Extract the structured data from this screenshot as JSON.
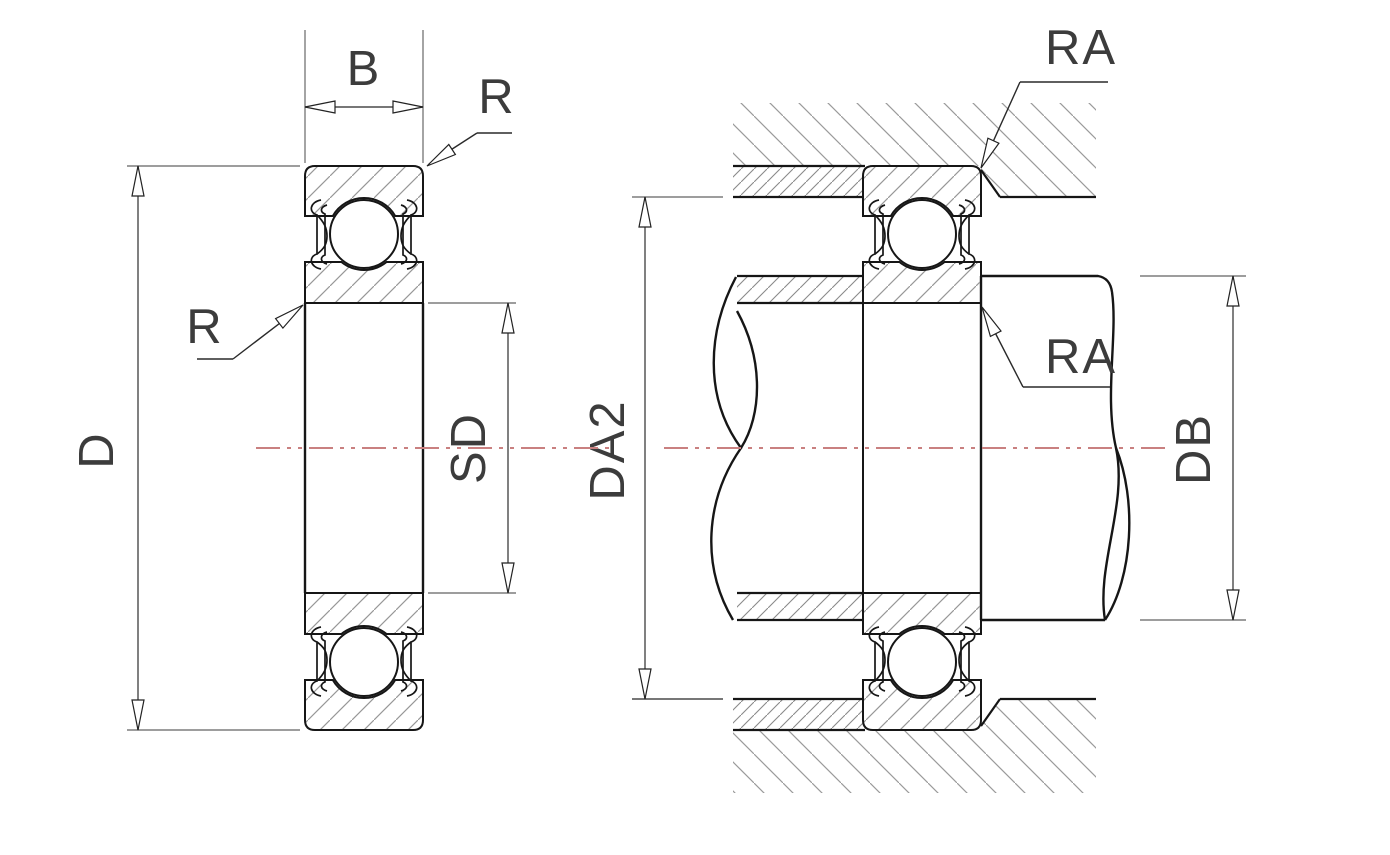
{
  "diagram": {
    "description": "Deep groove ball bearing cross-section drawing with mounting view",
    "left_view": {
      "labels": {
        "width": "B",
        "outer_radius": "R",
        "bore_radius": "R",
        "outer_diameter": "D",
        "shoulder_diameter": "SD"
      }
    },
    "right_view": {
      "labels": {
        "housing_abutment_diameter": "DA2",
        "housing_fillet_radius": "RA",
        "shaft_fillet_radius": "RA",
        "shaft_abutment_diameter": "DB"
      }
    },
    "colors": {
      "part_line": "#161616",
      "hatch": "#979797",
      "dense_hatch": "#8a8a8a",
      "dimension_line": "#4a4a4a",
      "extension_line": "#7d7d7d",
      "centerline": "#c98080",
      "label_text": "#3c3c3c",
      "background": "#ffffff"
    }
  }
}
